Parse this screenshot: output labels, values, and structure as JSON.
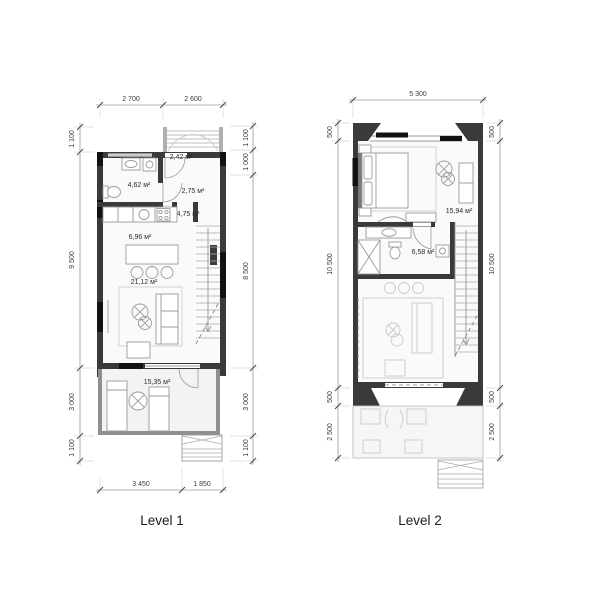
{
  "captions": {
    "level1": "Level 1",
    "level2": "Level 2"
  },
  "colors": {
    "wall_dark": "#3a3a3a",
    "wall_light": "#8f8f8f",
    "window_black": "#121212",
    "floor": "#fafafa",
    "terrace_floor": "#f3f3f3",
    "furniture_line": "#9a9a9a",
    "faint_line": "#c9c9c9",
    "dimension_line": "#9b9b9b",
    "text": "#2b2b2b"
  },
  "level1": {
    "dims": {
      "top": [
        "2 700",
        "2 600"
      ],
      "bottom": [
        "3 450",
        "1 850"
      ],
      "left": [
        "1 100",
        "9 500",
        "3 000",
        "1 100"
      ],
      "right": [
        "1 100",
        "1 000",
        "8 500",
        "3 000",
        "1 100"
      ]
    },
    "areas": {
      "entry": "2,42 м²",
      "bathroom": "4,62 м²",
      "hall": "2,75 м²",
      "corridor": "4,75 м²",
      "kitchen": "6,96 м²",
      "living": "21,12 м²",
      "terrace": "15,35 м²"
    }
  },
  "level2": {
    "dims": {
      "top": [
        "5 300"
      ],
      "left": [
        "500",
        "10 500",
        "500",
        "2 500"
      ],
      "right": [
        "500",
        "10 500",
        "500",
        "2 500"
      ]
    },
    "areas": {
      "bedroom": "15,94 м²",
      "bathroom": "6,58 м²"
    }
  }
}
